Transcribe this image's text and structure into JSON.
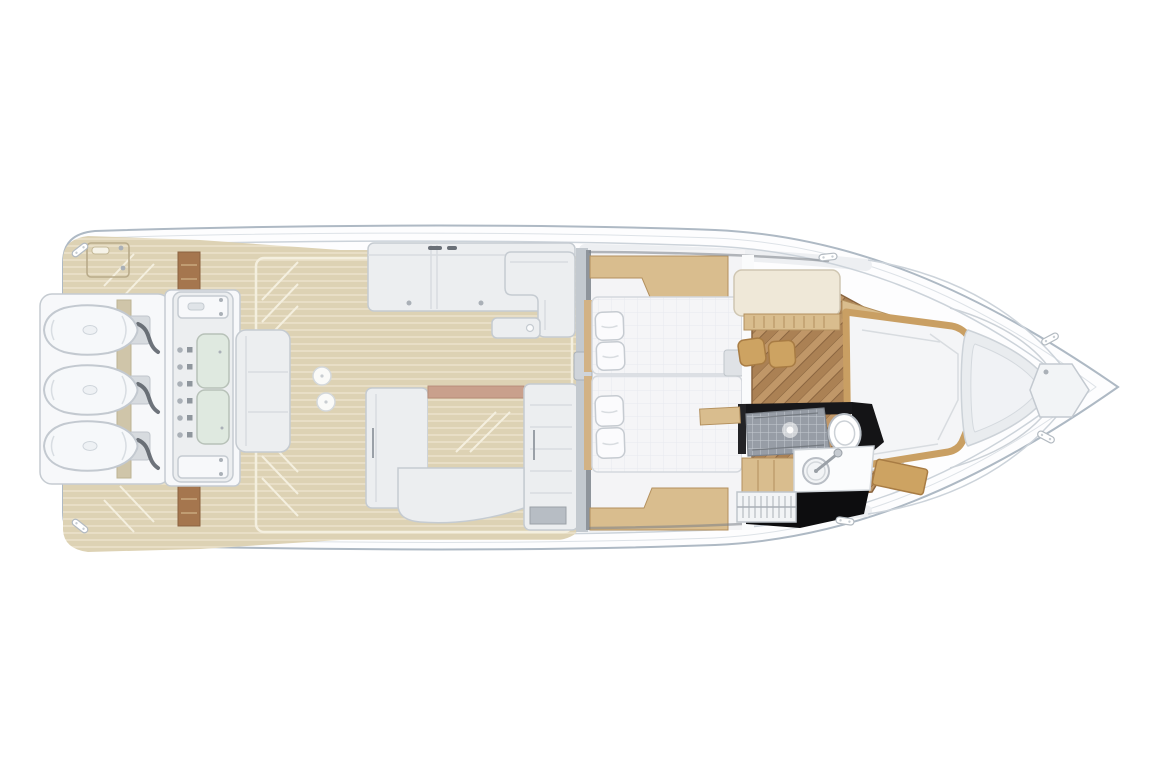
{
  "scene": {
    "description": "Overhead deck and cabin floor plan of a motor yacht with triple outboard engines",
    "view": "top-down",
    "engine_count": 3,
    "areas": {
      "stern": [
        "swim-platform",
        "outboard-engines",
        "transom-module-with-sinks",
        "aft-bench"
      ],
      "cockpit": [
        "teak-sole",
        "port-sunpad",
        "corner-seat",
        "u-shaped-seating",
        "deck-hatches"
      ],
      "cabin": [
        "twin-berths",
        "pillows",
        "wood-cabinetry",
        "nightstand"
      ],
      "salon": [
        "herringbone-floor",
        "galley-counter",
        "stools",
        "forward-berth"
      ],
      "head": [
        "shower",
        "toilet",
        "vanity-sink",
        "companionway-steps"
      ],
      "bow": [
        "molded-deck-contours",
        "anchor-locker-hatch",
        "cleats"
      ]
    }
  },
  "colors": {
    "background": "#ffffff",
    "hull_fill": "#fdfdfe",
    "hull_outline": "#aeb9c4",
    "inner_line": "#ccd3da",
    "deck_shading": "#edeff2",
    "teak": "#ddd2b4",
    "teak_stripe": "#ece4cd",
    "teak_margin": "#f4efdf",
    "wood_step": "#a5764e",
    "wood_trim": "#d9bd8e",
    "wood_trim_dark": "#b3905e",
    "wood_frame": "#c99f63",
    "wood_floor": "#ab8154",
    "wood_floor_dark": "#8a6540",
    "wood_floor_light": "#c09768",
    "stool_wood": "#cda362",
    "seat_fill": "#eceef0",
    "seat_stroke": "#c5cbd1",
    "seat_seam": "#d8dce0",
    "white_fill": "#f7f8fa",
    "mattress_fill": "#f5f5f7",
    "mattress_stroke": "#d4d8dd",
    "sink_green": "#dfe9e0",
    "sink_stroke": "#b7c1b8",
    "hardware_gray": "#aab0b7",
    "cable_dark": "#565c64",
    "black_floor": "#0d0d0f",
    "tile_gray": "#979da6",
    "tile_line": "#c6cad1",
    "transom_tan": "#cfc5a9",
    "salmon_pad": "#c9a08c",
    "counter_cream": "#efe8d8"
  }
}
